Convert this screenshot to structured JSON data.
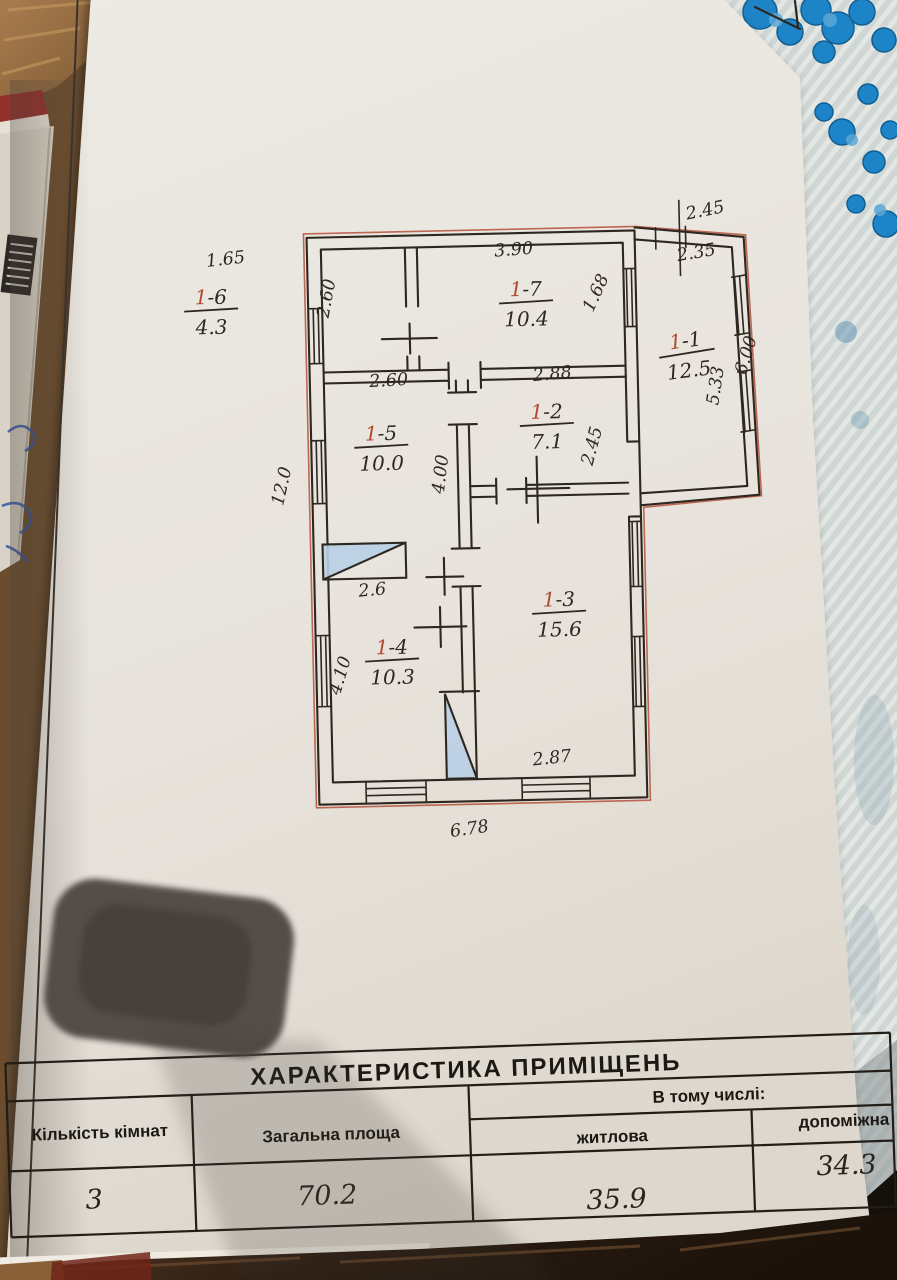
{
  "document": {
    "kind": "hand-drawn apartment floor plan sheet, photographed on a table"
  },
  "plan": {
    "rooms": [
      {
        "id": "1-6",
        "area": "4.3"
      },
      {
        "id": "1-7",
        "area": "10.4"
      },
      {
        "id": "1-1",
        "area": "12.5"
      },
      {
        "id": "1-5",
        "area": "10.0"
      },
      {
        "id": "1-2",
        "area": "7.1"
      },
      {
        "id": "1-3",
        "area": "15.6"
      },
      {
        "id": "1-4",
        "area": "10.3"
      }
    ],
    "dimensions": [
      {
        "label": "1.65"
      },
      {
        "label": "2.60"
      },
      {
        "label": "3.90"
      },
      {
        "label": "1.68"
      },
      {
        "label": "2.45"
      },
      {
        "label": "2.35"
      },
      {
        "label": "5.33"
      },
      {
        "label": "6.00"
      },
      {
        "label": "2.60"
      },
      {
        "label": "2.88"
      },
      {
        "label": "2.45"
      },
      {
        "label": "4.00"
      },
      {
        "label": "12.0"
      },
      {
        "label": "2.6"
      },
      {
        "label": "4.10"
      },
      {
        "label": "2.87"
      },
      {
        "label": "6.78"
      }
    ],
    "colors": {
      "ink": "#2e2720",
      "red_pencil": "#b0492f",
      "stair_fill": "#b9cfe6"
    }
  },
  "table": {
    "title": "ХАРАКТЕРИСТИКА   ПРИМІЩЕНЬ",
    "headers": {
      "rooms_count": "Кількість кімнат",
      "total_area": "Загальна площа",
      "including": "В тому числі:",
      "living": "житлова",
      "auxiliary": "допоміжна"
    },
    "values": {
      "rooms_count": "3",
      "total_area": "70.2",
      "living": "35.9",
      "auxiliary": "34.3"
    }
  }
}
